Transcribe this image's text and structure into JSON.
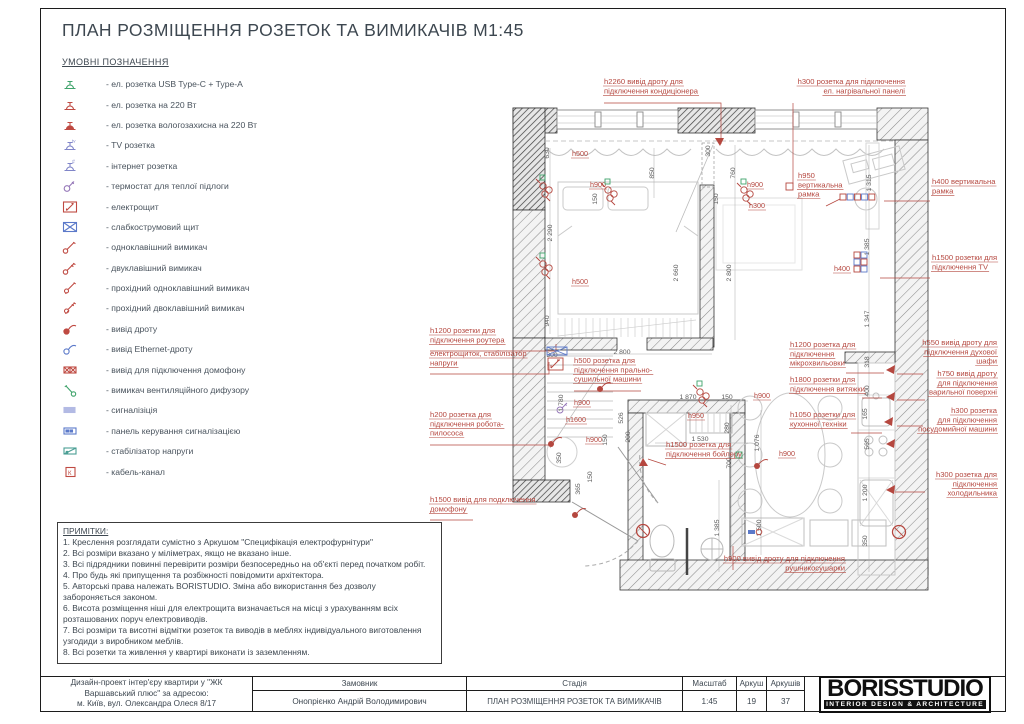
{
  "page": {
    "title": "ПЛАН РОЗМІЩЕННЯ РОЗЕТОК ТА ВИМИКАЧІВ М1:45"
  },
  "legend": {
    "heading": "УМОВНІ ПОЗНАЧЕННЯ",
    "items": [
      {
        "icon": "socket-usb",
        "color": "#3fa36b",
        "label": "- ел. розетка USB Type-C + Type-A"
      },
      {
        "icon": "socket-220",
        "color": "#bf4a42",
        "label": "- ел. розетка на 220 Вт"
      },
      {
        "icon": "socket-wet",
        "color": "#bf4a42",
        "label": "- ел. розетка вологозахисна на 220 Вт"
      },
      {
        "icon": "socket-tv",
        "color": "#8085c8",
        "label": "- TV розетка"
      },
      {
        "icon": "socket-net",
        "color": "#8085c8",
        "label": "- інтернет розетка"
      },
      {
        "icon": "thermostat",
        "color": "#9577b8",
        "label": "- термостат для теплої підлоги"
      },
      {
        "icon": "electro-panel",
        "color": "#bf4a42",
        "label": "- електрощит"
      },
      {
        "icon": "weak-panel",
        "color": "#5b79c9",
        "label": "- слабкострумовий щит"
      },
      {
        "icon": "switch-1",
        "color": "#bf4a42",
        "label": "- одноклавішний вимикач"
      },
      {
        "icon": "switch-2",
        "color": "#bf4a42",
        "label": "- двуклавішний вимикач"
      },
      {
        "icon": "switch-1-pass",
        "color": "#bf4a42",
        "label": "- прохідний одноклавішний вимикач"
      },
      {
        "icon": "switch-2-pass",
        "color": "#bf4a42",
        "label": "- прохідний двоклавішний вимикач"
      },
      {
        "icon": "wire-out",
        "color": "#bf4a42",
        "label": "- вивід дроту"
      },
      {
        "icon": "ethernet-out",
        "color": "#5b79c9",
        "label": "- вивід Ethernet-дроту"
      },
      {
        "icon": "domofon-out",
        "color": "#bf4a42",
        "label": "- вивід для підключення домофону"
      },
      {
        "icon": "vent-switch",
        "color": "#3fa36b",
        "label": "- вимикач вентиляційного дифузору"
      },
      {
        "icon": "alarm",
        "color": "#9aa3dc",
        "label": "- сигналізіція"
      },
      {
        "icon": "alarm-panel",
        "color": "#5b79c9",
        "label": "- панель керування сигналізацією"
      },
      {
        "icon": "stabilizer",
        "color": "#4a9e94",
        "label": "- стабілізатор напруги"
      },
      {
        "icon": "cable-channel",
        "color": "#bf4a42",
        "label": "- кабель-канал"
      }
    ]
  },
  "notes": {
    "heading": "ПРИМІТКИ:",
    "lines": [
      "1. Креслення розглядати сумістно з Аркушом \"Специфікація електрофурнітури\"",
      "2. Всі розміри вказано у міліметрах, якщо не вказано інше.",
      "3. Всі підрядники повинні перевірити розміри безпосередньо на об'єкті перед початком робіт.",
      "4. Про будь які припущення та розбіжності повідомити архітектора.",
      "5. Авторські права належать BORISTUDIO. Зміна або використання без дозволу забороняється законом.",
      "6. Висота розміщення ніші для електрощита визначається на місці з урахуванням всіх розташованих поруч електровиводів.",
      "7. Всі розміри та висотні відмітки розеток та виводів в меблях індивідуального виготовлення узгодиди з виробником меблів.",
      "8. Всі розетки та живлення у квартирі виконати із заземленням."
    ]
  },
  "titleblock": {
    "project_lines": [
      "Дизайн-проект інтер'єру квартири у \"ЖК",
      "Варшавський плюс\" за адресою:",
      "м. Київ, вул. Олександра Олеся 8/17"
    ],
    "customer_label": "Замовник",
    "customer": "Онопрієнко Андрій Володимирович",
    "stage_label": "Стадія",
    "stage": "ПЛАН РОЗМІЩЕННЯ РОЗЕТОК ТА ВИМИКАЧІВ",
    "scale_label": "Масштаб",
    "scale": "1:45",
    "sheet_label": "Аркуш",
    "sheet": "19",
    "sheets_label": "Аркушів",
    "sheets": "37",
    "logo": "BORISSTUDIO",
    "logo_sub": "INTERIOR DESIGN & ARCHITECTURE"
  },
  "plan": {
    "accent_red": "#b5473f",
    "dim_gray": "#5a5a5a",
    "callouts": [
      {
        "x": 604,
        "y": 84,
        "align": "left",
        "lines": [
          "h2260 вивід дроту для",
          "підключення кондиціонера"
        ],
        "leader": [
          [
            604,
            103
          ],
          [
            721,
            103
          ],
          [
            721,
            144
          ]
        ]
      },
      {
        "x": 905,
        "y": 84,
        "align": "right",
        "lines": [
          "h300 розетка для підключення",
          "ел. нагрівальної панелі"
        ],
        "leader": [
          [
            793,
            103
          ],
          [
            793,
            184
          ]
        ]
      },
      {
        "x": 798,
        "y": 178,
        "align": "left",
        "lines": [
          "h950",
          "вертикальна",
          "рамка"
        ],
        "leader": [
          [
            826,
            206
          ],
          [
            840,
            199
          ]
        ]
      },
      {
        "x": 932,
        "y": 184,
        "align": "left",
        "lines": [
          "h400 вертикальна",
          "рамка"
        ],
        "leader": [
          [
            930,
            201
          ],
          [
            884,
            201
          ]
        ]
      },
      {
        "x": 932,
        "y": 260,
        "align": "left",
        "lines": [
          "h1500 розетки для",
          "підключення TV"
        ],
        "leader": [
          [
            930,
            278
          ],
          [
            880,
            278
          ]
        ]
      },
      {
        "x": 430,
        "y": 333,
        "align": "left",
        "lines": [
          "h1200 розетки для",
          "підключення роутера"
        ],
        "leader": [
          [
            430,
            351
          ],
          [
            556,
            351
          ],
          [
            556,
            344
          ]
        ]
      },
      {
        "x": 430,
        "y": 356,
        "align": "left",
        "lines": [
          "електрощиток, стабілізатор",
          "напруги"
        ],
        "leader": [
          [
            430,
            374
          ],
          [
            549,
            374
          ],
          [
            549,
            362
          ]
        ]
      },
      {
        "x": 574,
        "y": 363,
        "align": "left",
        "lines": [
          "h500 розетка для",
          "підключення прально-",
          "сушильної машини"
        ],
        "leader": [
          [
            574,
            391
          ],
          [
            641,
            391
          ]
        ]
      },
      {
        "x": 790,
        "y": 347,
        "align": "left",
        "lines": [
          "h1200 розетка для",
          "підключення",
          "мікрохвильовки"
        ],
        "leader": [
          [
            846,
            373
          ],
          [
            884,
            373
          ]
        ]
      },
      {
        "x": 997,
        "y": 345,
        "align": "right",
        "lines": [
          "h550 вивід дроту для",
          "підключення духової",
          "шафи"
        ],
        "leader": [
          [
            923,
            374
          ],
          [
            897,
            374
          ]
        ]
      },
      {
        "x": 997,
        "y": 376,
        "align": "right",
        "lines": [
          "h750 вивід дроту",
          "для підключення",
          "варильної поверхні"
        ],
        "leader": [
          [
            925,
            400
          ],
          [
            897,
            400
          ]
        ]
      },
      {
        "x": 790,
        "y": 382,
        "align": "left",
        "lines": [
          "h1800 розетки для",
          "підключення витяжки"
        ],
        "leader": [
          [
            862,
            398
          ],
          [
            882,
            398
          ]
        ]
      },
      {
        "x": 430,
        "y": 417,
        "align": "left",
        "lines": [
          "h200 розетка для",
          "підключення робота-",
          "пилососа"
        ],
        "leader": [
          [
            430,
            445
          ],
          [
            551,
            445
          ]
        ]
      },
      {
        "x": 790,
        "y": 417,
        "align": "left",
        "lines": [
          "h1050 розетки для",
          "кухонної техніки"
        ],
        "leader": [
          [
            851,
            433
          ],
          [
            882,
            433
          ]
        ]
      },
      {
        "x": 997,
        "y": 413,
        "align": "right",
        "lines": [
          "h300 розетка",
          "для підключення",
          "посудомийної машини"
        ],
        "leader": [
          [
            923,
            426
          ],
          [
            897,
            426
          ]
        ]
      },
      {
        "x": 666,
        "y": 447,
        "align": "left",
        "lines": [
          "h1500 розетка для",
          "підключення бойлеру"
        ],
        "leader": [
          [
            666,
            465
          ],
          [
            648,
            459
          ]
        ]
      },
      {
        "x": 997,
        "y": 477,
        "align": "right",
        "lines": [
          "h300 розетка для",
          "підключення",
          "холодильника"
        ],
        "leader": [
          [
            925,
            492
          ],
          [
            895,
            492
          ]
        ]
      },
      {
        "x": 430,
        "y": 502,
        "align": "left",
        "lines": [
          "h1500 вивід для подключення",
          "домофону"
        ],
        "leader": [
          [
            430,
            520
          ],
          [
            473,
            520
          ]
        ]
      },
      {
        "x": 845,
        "y": 561,
        "align": "right",
        "lines": [
          "h900 вивід дроту для підключення",
          "рушникосушарки"
        ],
        "leader": [
          [
            733,
            570
          ],
          [
            733,
            546
          ]
        ]
      }
    ],
    "labels": [
      {
        "t": "h500",
        "x": 572,
        "y": 156
      },
      {
        "t": "h500",
        "x": 572,
        "y": 284
      },
      {
        "t": "h900",
        "x": 590,
        "y": 187
      },
      {
        "t": "h900",
        "x": 747,
        "y": 187
      },
      {
        "t": "h300",
        "x": 749,
        "y": 208
      },
      {
        "t": "h900",
        "x": 574,
        "y": 405
      },
      {
        "t": "h1600",
        "x": 566,
        "y": 422
      },
      {
        "t": "h900",
        "x": 586,
        "y": 442
      },
      {
        "t": "h950",
        "x": 688,
        "y": 418
      },
      {
        "t": "h900",
        "x": 754,
        "y": 398
      },
      {
        "t": "h900",
        "x": 779,
        "y": 456
      },
      {
        "t": "h400",
        "x": 834,
        "y": 271
      }
    ],
    "dimensions": [
      {
        "t": "630",
        "x": 549,
        "y": 153,
        "r": 1
      },
      {
        "t": "2 290",
        "x": 552,
        "y": 233,
        "r": 1
      },
      {
        "t": "940",
        "x": 549,
        "y": 321,
        "r": 1
      },
      {
        "t": "850",
        "x": 654,
        "y": 173,
        "r": 1
      },
      {
        "t": "300",
        "x": 710,
        "y": 151,
        "r": 1
      },
      {
        "t": "760",
        "x": 735,
        "y": 173,
        "r": 1
      },
      {
        "t": "150",
        "x": 597,
        "y": 199,
        "r": 1
      },
      {
        "t": "150",
        "x": 718,
        "y": 199,
        "r": 1
      },
      {
        "t": "2 660",
        "x": 678,
        "y": 273,
        "r": 1
      },
      {
        "t": "2 800",
        "x": 731,
        "y": 273,
        "r": 1
      },
      {
        "t": "1 315",
        "x": 871,
        "y": 183,
        "r": 1
      },
      {
        "t": "1 385",
        "x": 869,
        "y": 247,
        "r": 1
      },
      {
        "t": "1 347",
        "x": 869,
        "y": 319,
        "r": 1
      },
      {
        "t": "318",
        "x": 869,
        "y": 362,
        "r": 1
      },
      {
        "t": "400",
        "x": 869,
        "y": 391,
        "r": 1
      },
      {
        "t": "165",
        "x": 867,
        "y": 414,
        "r": 1
      },
      {
        "t": "565",
        "x": 869,
        "y": 444,
        "r": 1
      },
      {
        "t": "1 200",
        "x": 867,
        "y": 493,
        "r": 1
      },
      {
        "t": "350",
        "x": 867,
        "y": 541,
        "r": 1
      },
      {
        "t": "300",
        "x": 552,
        "y": 357,
        "r": 0
      },
      {
        "t": "2 800",
        "x": 622,
        "y": 354,
        "r": 0
      },
      {
        "t": "1 780",
        "x": 563,
        "y": 403,
        "r": 1
      },
      {
        "t": "350",
        "x": 561,
        "y": 458,
        "r": 1
      },
      {
        "t": "526",
        "x": 623,
        "y": 418,
        "r": 1
      },
      {
        "t": "150",
        "x": 607,
        "y": 440,
        "r": 1
      },
      {
        "t": "1 870",
        "x": 688,
        "y": 399,
        "r": 0
      },
      {
        "t": "150",
        "x": 727,
        "y": 399,
        "r": 0
      },
      {
        "t": "200",
        "x": 630,
        "y": 437,
        "r": 1
      },
      {
        "t": "1 530",
        "x": 700,
        "y": 441,
        "r": 0
      },
      {
        "t": "280",
        "x": 729,
        "y": 428,
        "r": 1
      },
      {
        "t": "700",
        "x": 731,
        "y": 463,
        "r": 1
      },
      {
        "t": "1 076",
        "x": 759,
        "y": 443,
        "r": 1
      },
      {
        "t": "1 385",
        "x": 719,
        "y": 528,
        "r": 1
      },
      {
        "t": "1 500",
        "x": 761,
        "y": 528,
        "r": 1
      },
      {
        "t": "365",
        "x": 580,
        "y": 489,
        "r": 1
      },
      {
        "t": "150",
        "x": 592,
        "y": 477,
        "r": 1
      }
    ],
    "symbols": [
      {
        "k": "sockets",
        "x": 543,
        "y": 186
      },
      {
        "k": "sockets",
        "x": 543,
        "y": 264
      },
      {
        "k": "sockets",
        "x": 608,
        "y": 190
      },
      {
        "k": "sockets",
        "x": 744,
        "y": 190
      },
      {
        "k": "sockets",
        "x": 700,
        "y": 392
      },
      {
        "k": "frame-row5",
        "x": 840,
        "y": 194
      },
      {
        "k": "tv-block",
        "x": 854,
        "y": 252
      },
      {
        "k": "red-sq",
        "x": 786,
        "y": 183
      },
      {
        "k": "arrow-d",
        "x": 720,
        "y": 146
      },
      {
        "k": "arrow-l",
        "x": 886,
        "y": 370
      },
      {
        "k": "arrow-l",
        "x": 886,
        "y": 397
      },
      {
        "k": "arrow-l",
        "x": 884,
        "y": 422
      },
      {
        "k": "arrow-l",
        "x": 886,
        "y": 444
      },
      {
        "k": "arrow-l",
        "x": 886,
        "y": 490
      },
      {
        "k": "arrow-u",
        "x": 643,
        "y": 458
      },
      {
        "k": "panel",
        "x": 547,
        "y": 347
      },
      {
        "k": "thermo",
        "x": 560,
        "y": 410
      },
      {
        "k": "tail",
        "x": 600,
        "y": 389
      },
      {
        "k": "tail",
        "x": 551,
        "y": 444
      },
      {
        "k": "tail",
        "x": 575,
        "y": 515
      },
      {
        "k": "tail",
        "x": 757,
        "y": 466
      },
      {
        "k": "green-sq",
        "x": 736,
        "y": 452
      },
      {
        "k": "no-entry",
        "x": 643,
        "y": 531
      },
      {
        "k": "no-entry",
        "x": 899,
        "y": 532
      },
      {
        "k": "blue-red",
        "x": 748,
        "y": 530
      }
    ]
  }
}
